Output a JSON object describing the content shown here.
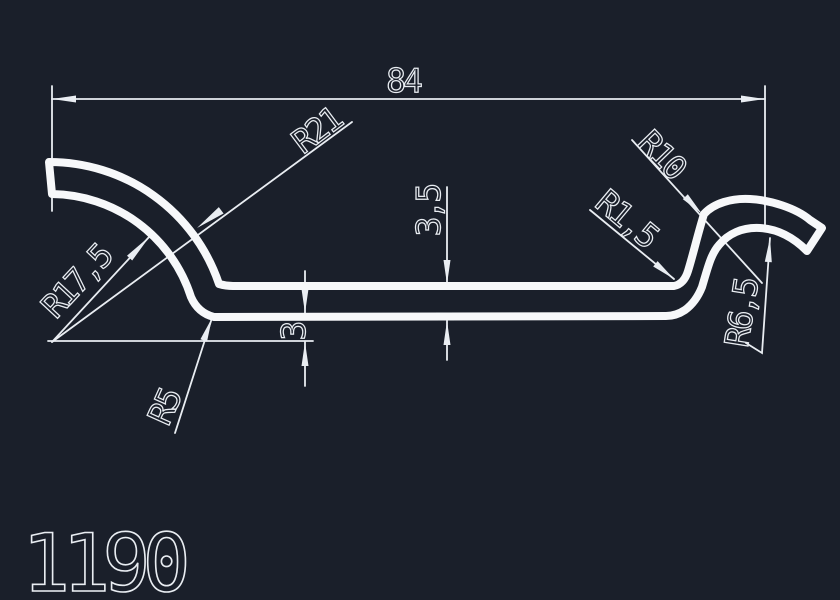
{
  "drawing": {
    "type": "cad-profile-cross-section",
    "part_number": "1190",
    "labels": {
      "width": "84",
      "thickness": "3",
      "thickness_outer": "3,5",
      "r21": "R21",
      "r17_5": "R17,5",
      "r5": "R5",
      "r10": "R10",
      "r1_5": "R1,5",
      "r6_5": "R6,5"
    },
    "colors": {
      "background": "#1a1f2a",
      "line": "#f7f8fa",
      "dim": "#e9edf2"
    }
  }
}
